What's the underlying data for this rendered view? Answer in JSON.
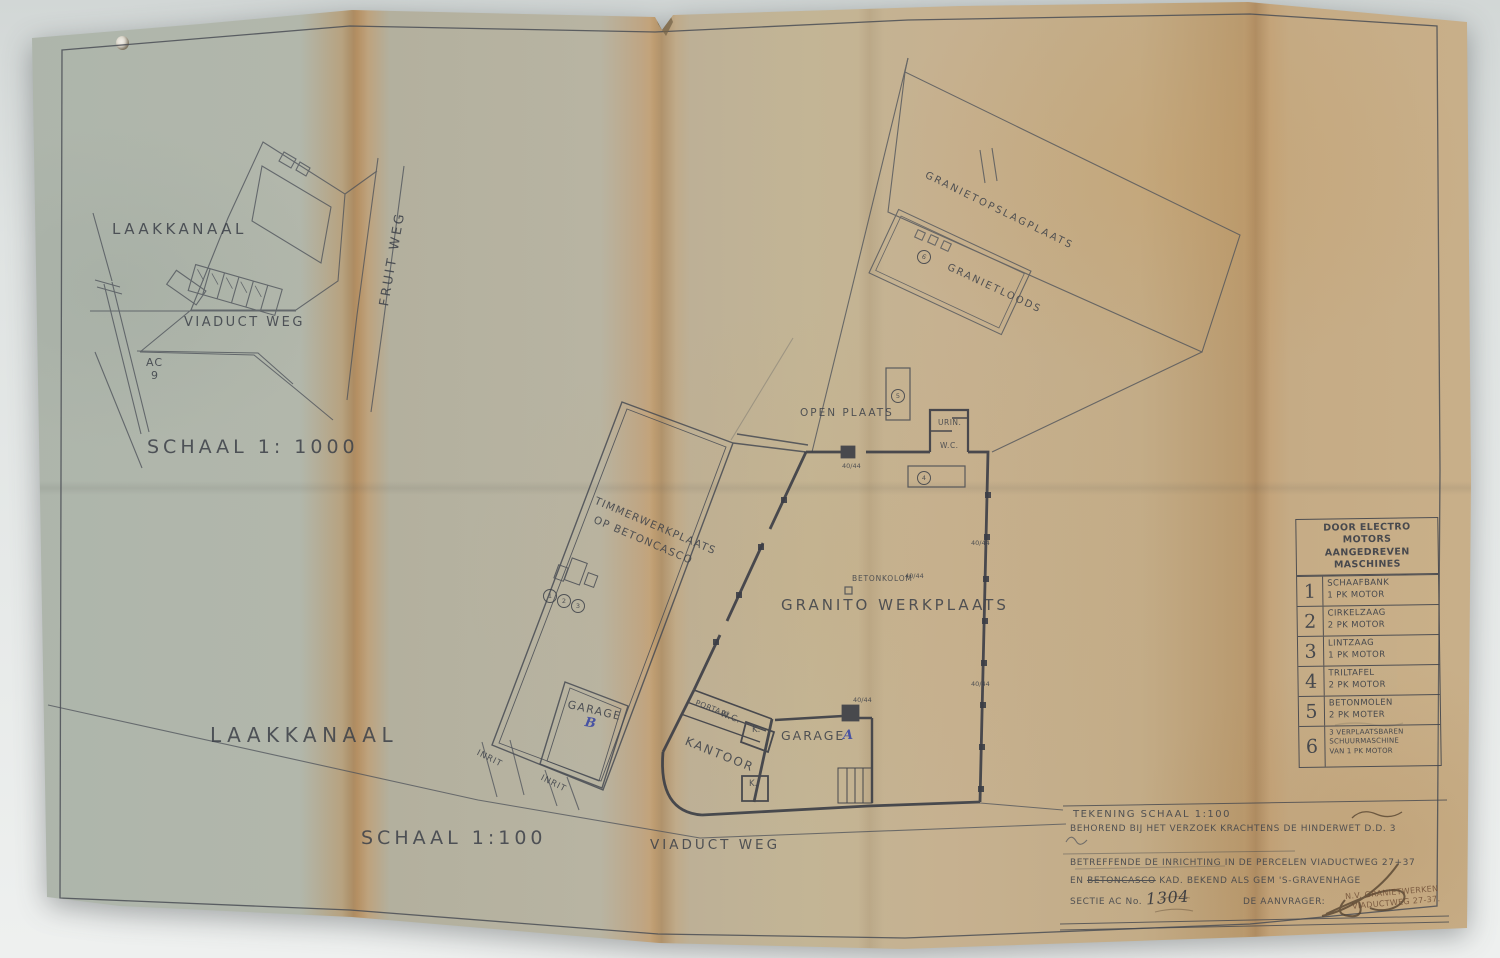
{
  "colors": {
    "ink": "#3d4149",
    "accent_blue": "#3c49a4",
    "paper_left": "#b0b7ad",
    "paper_right": "#c9b08a",
    "background": "#e4e7e6"
  },
  "inset_map": {
    "scale_label": "SCHAAL 1: 1000",
    "laakkanaal": "LAAKKANAAL",
    "viaduct_weg": "VIADUCT WEG",
    "fruit_weg": "FRUIT WEG",
    "section_code": "AC",
    "section_number": "9"
  },
  "plan": {
    "scale_label": "SCHAAL 1:100",
    "viaduct_weg": "VIADUCT WEG",
    "laakkanaal": "LAAKKANAAL",
    "granietopslagplaats": "GRANIETOPSLAGPLAATS",
    "granietloods": "GRANIETLOODS",
    "open_plaats": "OPEN PLAATS",
    "urinoir": "URIN.",
    "wc_north": "W.C.",
    "granito_werkplaats": "GRANITO WERKPLAATS",
    "betonkolom": "BETONKOLOM",
    "dim": "40/44",
    "timmer_line1": "TIMMERWERKPLAATS",
    "timmer_line2": "OP BETONCASCO",
    "garage_label": "GARAGE",
    "garage_a_letter": "A",
    "garage_b_letter": "B",
    "kantoor": "KANTOOR",
    "portaal": "PORTAAL",
    "wc_south": "W.C.",
    "kast": "K.",
    "inrit": "INRIT",
    "machines": {
      "m1": "1",
      "m2": "2",
      "m3": "3",
      "m4": "4",
      "m5": "5",
      "m6": "6"
    }
  },
  "machine_table": {
    "title_line1": "DOOR ELECTRO MOTORS",
    "title_line2": "AANGEDREVEN MASCHINES",
    "rows": [
      {
        "num": "1",
        "line1": "SCHAAFBANK",
        "line2": "1 PK MOTOR"
      },
      {
        "num": "2",
        "line1": "CIRKELZAAG",
        "line2": "2 PK MOTOR"
      },
      {
        "num": "3",
        "line1": "LINTZAAG",
        "line2": "1 PK MOTOR"
      },
      {
        "num": "4",
        "line1": "TRILTAFEL",
        "line2": "2 PK MOTOR"
      },
      {
        "num": "5",
        "line1": "BETONMOLEN",
        "line2": "2 PK MOTER"
      },
      {
        "num": "6",
        "line1": "3 VERPLAATSBAREN",
        "line2": "SCHUURMASCHINE",
        "line3": "VAN 1 PK MOTOR"
      }
    ]
  },
  "title_block": {
    "line1": "TEKENING SCHAAL 1:100",
    "line2": "BEHOREND BIJ HET VERZOEK KRACHTENS DE HINDERWET D.D. 3",
    "line3": "BETREFFENDE DE INRICHTING IN DE PERCELEN VIADUCTWEG 27+37",
    "line4_pre": "EN",
    "line4_struck": "BETONCASCO",
    "line4_post": "KAD. BEKEND ALS GEM 'S-GRAVENHAGE",
    "line5_label": "SECTIE AC No.",
    "line5_number": "1304",
    "line5_suffix": "DE AANVRAGER:",
    "stamp_line1": "N.V. GRANIETWERKEN",
    "stamp_line2": "VIADUCTWEG 27-37."
  }
}
